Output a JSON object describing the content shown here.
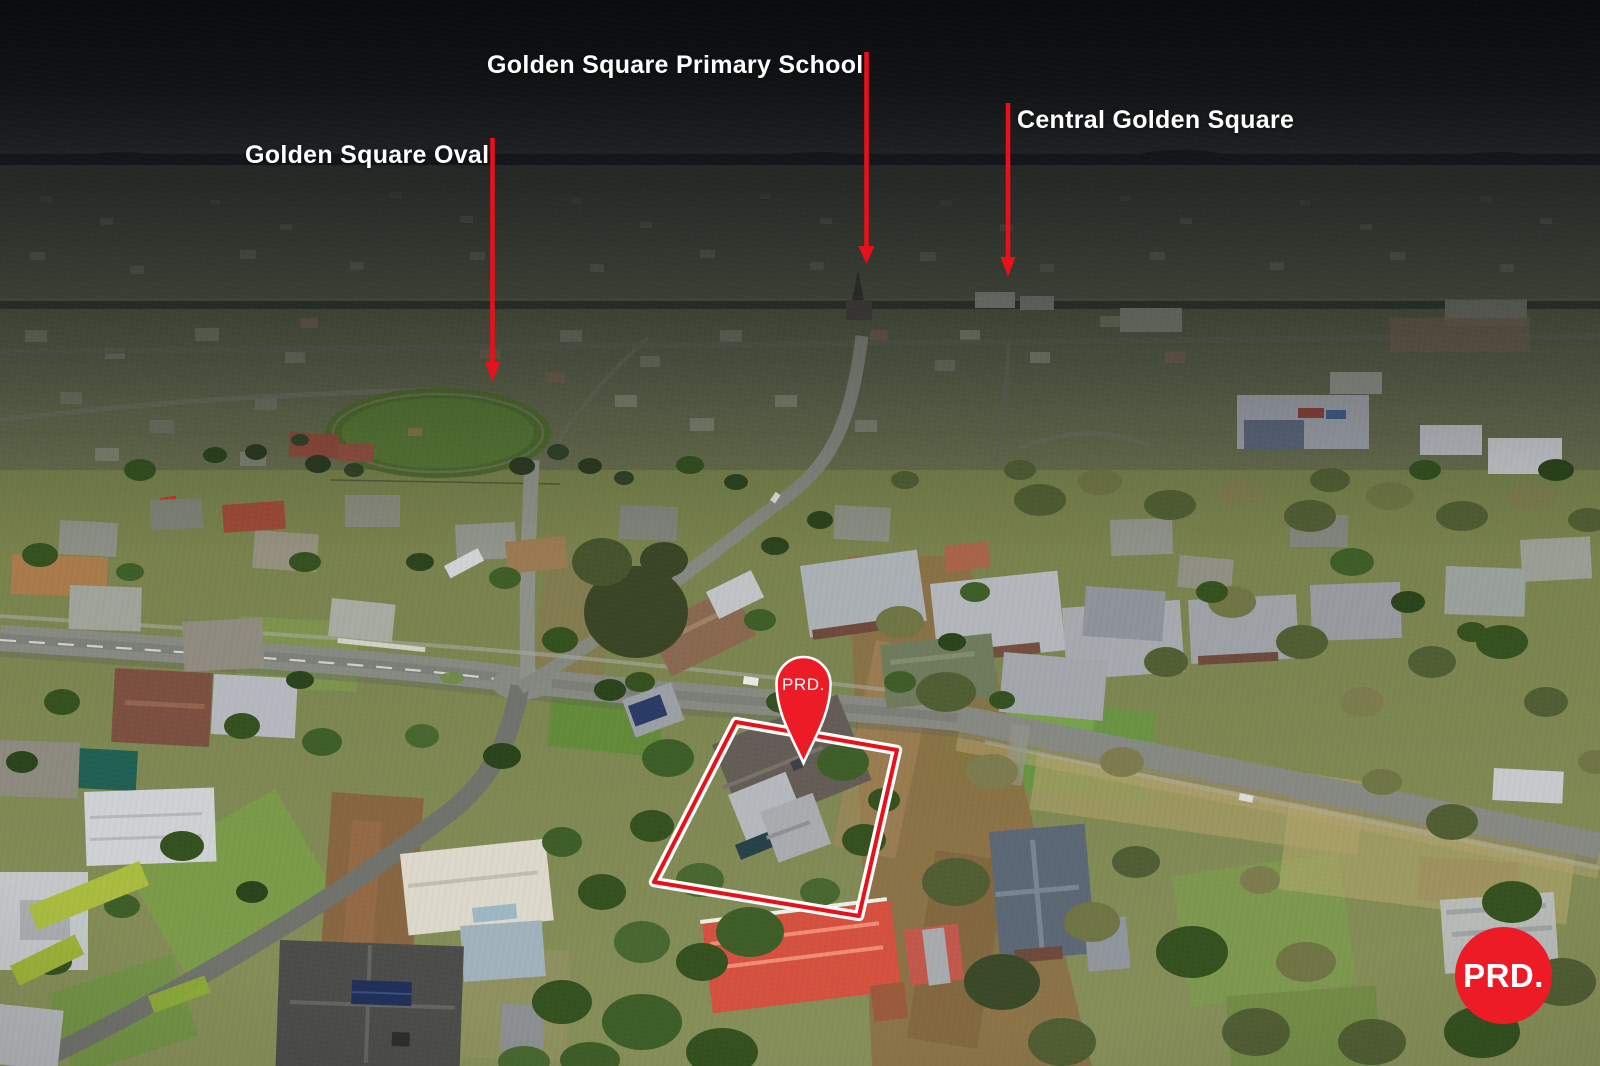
{
  "annotations": {
    "labels": [
      {
        "id": "golden-square-primary-school",
        "text": "Golden Square Primary School"
      },
      {
        "id": "central-golden-square",
        "text": "Central Golden Square"
      },
      {
        "id": "golden-square-oval",
        "text": "Golden Square Oval"
      }
    ]
  },
  "property_marker": {
    "pin_label": "PRD."
  },
  "watermark": {
    "logo_text": "PRD."
  },
  "colors": {
    "annotation_red": "#e8101a",
    "brand_red": "#ed1b26",
    "label_text": "#ffffff"
  }
}
